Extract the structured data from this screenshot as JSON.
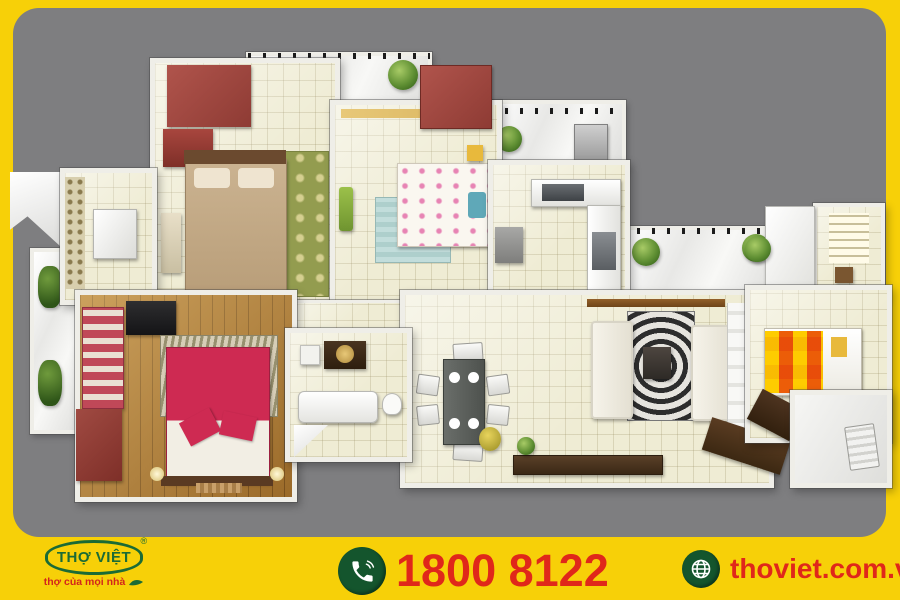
{
  "footer": {
    "logo": {
      "name": "THỢ VIỆT",
      "registered": "®",
      "tagline": "thợ của mọi nhà"
    },
    "phone": {
      "number": "1800 8122"
    },
    "website": {
      "url": "thoviet.com.vn"
    }
  },
  "colors": {
    "frame_yellow": "#F7D008",
    "canvas_gray": "#7E7E80",
    "accent_red": "#E0271A",
    "brand_green": "#1B6B35",
    "floor_cream": "#EFECD4",
    "wood_brown": "#B0792F",
    "wardrobe_maroon": "#99433C",
    "master_bed_crimson": "#CB2B56",
    "guest_bed_orange": "#F5A800"
  },
  "floorplan": {
    "type": "3d-apartment-floor-plan-top-view",
    "rooms": [
      {
        "id": "bedroom-top-left",
        "desc": "bedroom with tan bed, maroon wardrobe, green rug"
      },
      {
        "id": "balcony-top",
        "desc": "white balcony with two plants and dark railing"
      },
      {
        "id": "bedroom-top-middle",
        "desc": "bedroom with white floral bed, teal rug, maroon wardrobe"
      },
      {
        "id": "kitchen",
        "desc": "L-shaped white kitchen counter with sink and appliance"
      },
      {
        "id": "utility-balcony",
        "desc": "small balcony with washer and plant"
      },
      {
        "id": "balcony-right",
        "desc": "long white balcony with two plants"
      },
      {
        "id": "living-room",
        "desc": "two white sofas, zebra rug, coffee table"
      },
      {
        "id": "dining-area",
        "desc": "dark dining table with six chairs and plates"
      },
      {
        "id": "master-bedroom",
        "desc": "wood floor, crimson bed, striped sofa, black TV unit, maroon wardrobe"
      },
      {
        "id": "bathroom-center",
        "desc": "bathtub, vanity with round basin, toilet"
      },
      {
        "id": "bathroom-left",
        "desc": "small tiled room with white cabinets"
      },
      {
        "id": "bathroom-right-top",
        "desc": "small room with window"
      },
      {
        "id": "bedroom-right",
        "desc": "bedroom with orange checkered bed"
      },
      {
        "id": "study-right",
        "desc": "small white room with chair"
      },
      {
        "id": "balcony-left",
        "desc": "narrow balcony with plants"
      },
      {
        "id": "hallway",
        "desc": "tiled corridor connecting rooms"
      }
    ]
  }
}
